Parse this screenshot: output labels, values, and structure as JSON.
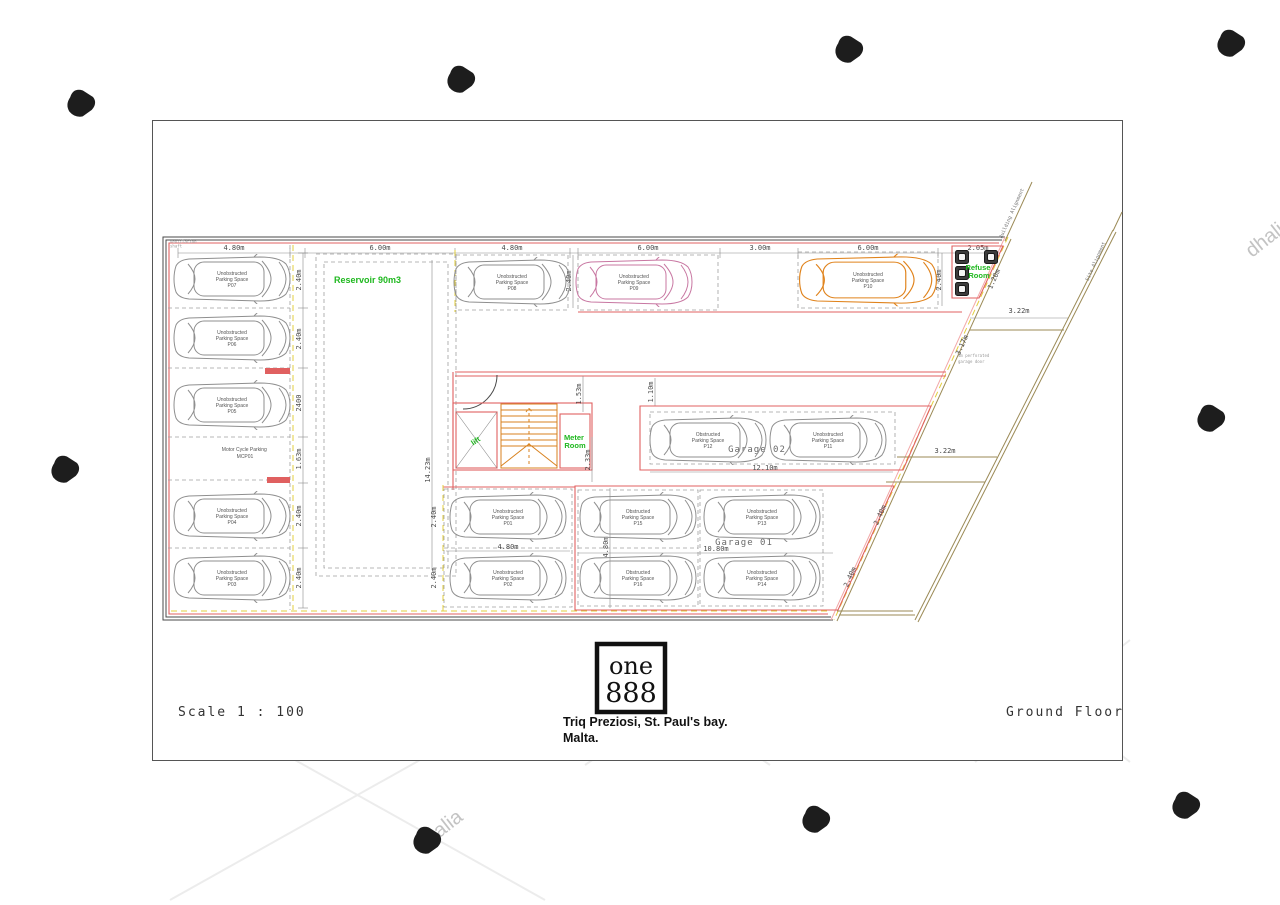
{
  "watermarks": {
    "brand": "dhalia",
    "center_line1": "propertymalta",
    "center_line2": "rent | buy | sell"
  },
  "titleblock": {
    "scale": "Scale 1 : 100",
    "floor": "Ground Floor",
    "logo_top": "one",
    "logo_bottom": "888",
    "address1": "Triq Preziosi, St. Paul's bay.",
    "address2": "Malta."
  },
  "plan": {
    "labels": {
      "reservoir": "Reservoir 90m3",
      "refuse1": "Refuse",
      "refuse2": "Room",
      "lift": "lift",
      "meter1": "Meter",
      "meter2": "Room",
      "garage02": "Garage 02",
      "garage01": "Garage 01",
      "moto1": "Motor Cycle Parking",
      "moto2": "MCP01",
      "building_alignment": "Building Alignment",
      "site_alignment": "Site Alignment",
      "door_note1": "4m perforated",
      "door_note2": "garage door",
      "corner_note1": "ventilation",
      "corner_note2": "shaft"
    },
    "dims": [
      "4.80m",
      "6.00m",
      "4.80m",
      "6.00m",
      "3.00m",
      "6.00m",
      "2.05m",
      "2.40m",
      "1.20m",
      "3.22m",
      "3.17m",
      "3.22m",
      "2.40m",
      "2.40m",
      "2400",
      "1.63m",
      "2.40m",
      "2.40m",
      "14.23m",
      "1.53m",
      "1.10m",
      "2.33m",
      "12.10m",
      "4.80m",
      "2.40m",
      "2.40m",
      "4.80m",
      "10.80m",
      "2.40m",
      "2.40m",
      "2.40m"
    ],
    "spaces": [
      {
        "t": "Unobstructed",
        "m": "Parking Space",
        "id": "P07"
      },
      {
        "t": "Unobstructed",
        "m": "Parking Space",
        "id": "P06"
      },
      {
        "t": "Unobstructed",
        "m": "Parking Space",
        "id": "P05"
      },
      {
        "t": "Unobstructed",
        "m": "Parking Space",
        "id": "P04"
      },
      {
        "t": "Unobstructed",
        "m": "Parking Space",
        "id": "P03"
      },
      {
        "t": "Unobstructed",
        "m": "Parking Space",
        "id": "P08"
      },
      {
        "t": "Unobstructed",
        "m": "Parking Space",
        "id": "P09"
      },
      {
        "t": "Unobstructed",
        "m": "Parking Space",
        "id": "P10"
      },
      {
        "t": "Obstructed",
        "m": "Parking Space",
        "id": "P12"
      },
      {
        "t": "Unobstructed",
        "m": "Parking Space",
        "id": "P11"
      },
      {
        "t": "Unobstructed",
        "m": "Parking Space",
        "id": "P01"
      },
      {
        "t": "Unobstructed",
        "m": "Parking Space",
        "id": "P02"
      },
      {
        "t": "Obstructed",
        "m": "Parking Space",
        "id": "P15"
      },
      {
        "t": "Obstructed",
        "m": "Parking Space",
        "id": "P16"
      },
      {
        "t": "Unobstructed",
        "m": "Parking Space",
        "id": "P13"
      },
      {
        "t": "Unobstructed",
        "m": "Parking Space",
        "id": "P14"
      }
    ]
  }
}
